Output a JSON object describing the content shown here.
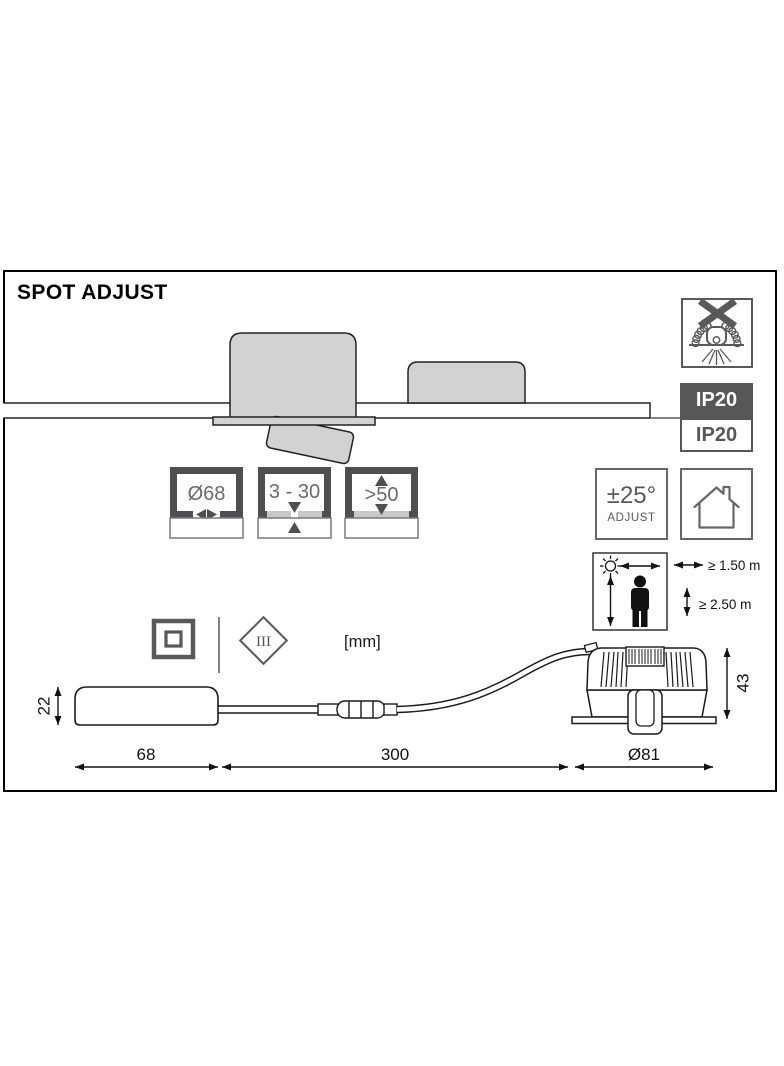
{
  "header": {
    "title": "SPOT ADJUST"
  },
  "ratings": {
    "ip_above_ceiling": "IP20",
    "ip_below_ceiling": "IP20"
  },
  "tilt": {
    "angle": "±25°",
    "label": "ADJUST"
  },
  "installation": {
    "cutout_diameter": "Ø68",
    "ceiling_thickness": "3 - 30",
    "min_clearance": ">50"
  },
  "sensor_zone": {
    "min_wall_distance": "≥ 1.50 m",
    "min_mounting_height": "≥ 2.50 m"
  },
  "marks": {
    "protection_class_3": "III",
    "units": "[mm]"
  },
  "product_dimensions": {
    "driver_height": "22",
    "driver_length": "68",
    "cable_length": "300",
    "spot_flange_diameter": "Ø81",
    "spot_height": "43"
  },
  "colors": {
    "badge_gray": "#555759",
    "gauge_frame_gray": "#4d4f51",
    "drawing_fill_gray": "#d2d2d2",
    "symbol_gray": "#666666",
    "line_black": "#111111"
  }
}
